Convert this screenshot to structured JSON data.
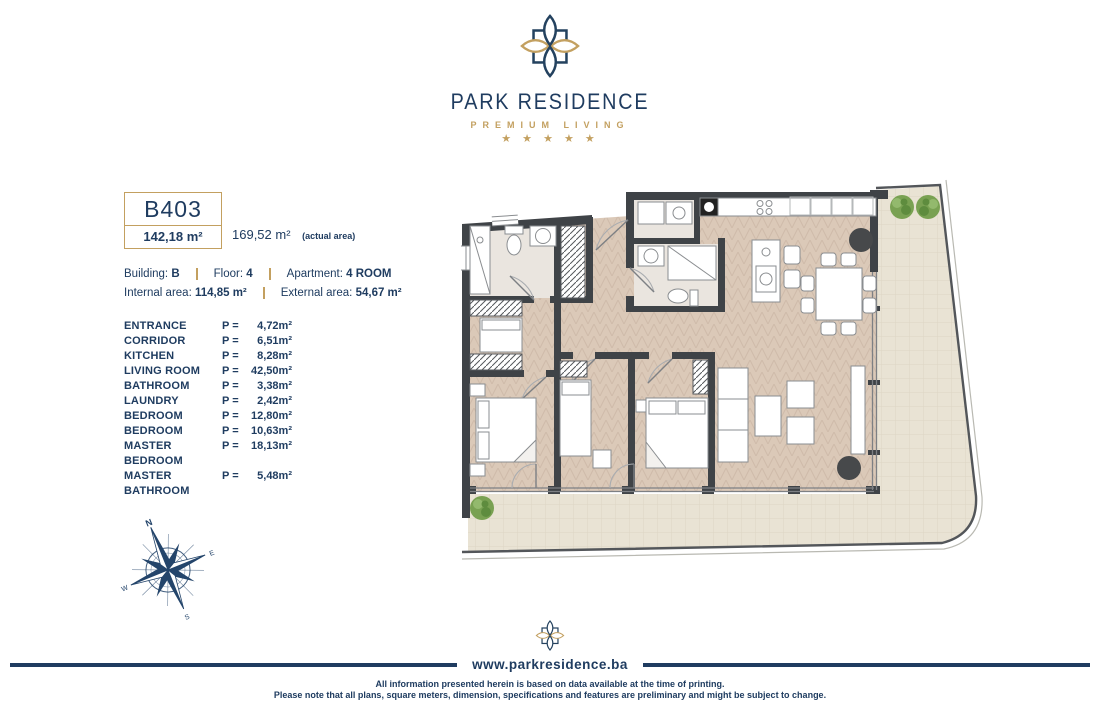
{
  "brand": {
    "name": "PARK RESIDENCE",
    "tagline": "PREMIUM LIVING",
    "stars": "★ ★ ★ ★ ★",
    "website": "www.parkresidence.ba"
  },
  "unit": {
    "code": "B403",
    "total_area": "142,18 m²",
    "actual_area": "169,52 m²",
    "actual_area_note": "(actual area)",
    "building_label": "Building:",
    "building": "B",
    "floor_label": "Floor:",
    "floor": "4",
    "apartment_label": "Apartment:",
    "apartment": "4 ROOM",
    "internal_label": "Internal area:",
    "internal": "114,85 m²",
    "external_label": "External area:",
    "external": "54,67 m²"
  },
  "rooms": {
    "prefix": "P =",
    "items": [
      {
        "name": "ENTRANCE",
        "area": "4,72m²"
      },
      {
        "name": "CORRIDOR",
        "area": "6,51m²"
      },
      {
        "name": "KITCHEN",
        "area": "8,28m²"
      },
      {
        "name": "LIVING ROOM",
        "area": "42,50m²"
      },
      {
        "name": "BATHROOM",
        "area": "3,38m²"
      },
      {
        "name": "LAUNDRY",
        "area": "2,42m²"
      },
      {
        "name": "BEDROOM",
        "area": "12,80m²"
      },
      {
        "name": "BEDROOM",
        "area": "10,63m²"
      },
      {
        "name": "MASTER BEDROOM",
        "area": "18,13m²"
      },
      {
        "name": "MASTER BATHROOM",
        "area": "5,48m²"
      }
    ]
  },
  "compass": {
    "n": "N",
    "e": "E",
    "s": "S",
    "w": "W"
  },
  "footer": {
    "line1": "All information presented herein is based on data available at the time of printing.",
    "line2": "Please note that all plans, square meters, dimension, specifications and features are preliminary and might be subject to change."
  },
  "colors": {
    "navy": "#1f3c60",
    "gold": "#c3a060",
    "wall": "#3f4347",
    "floor": "#dbc9b8",
    "terrace": "#e9e3d4",
    "tree": "#6f9c4a"
  }
}
